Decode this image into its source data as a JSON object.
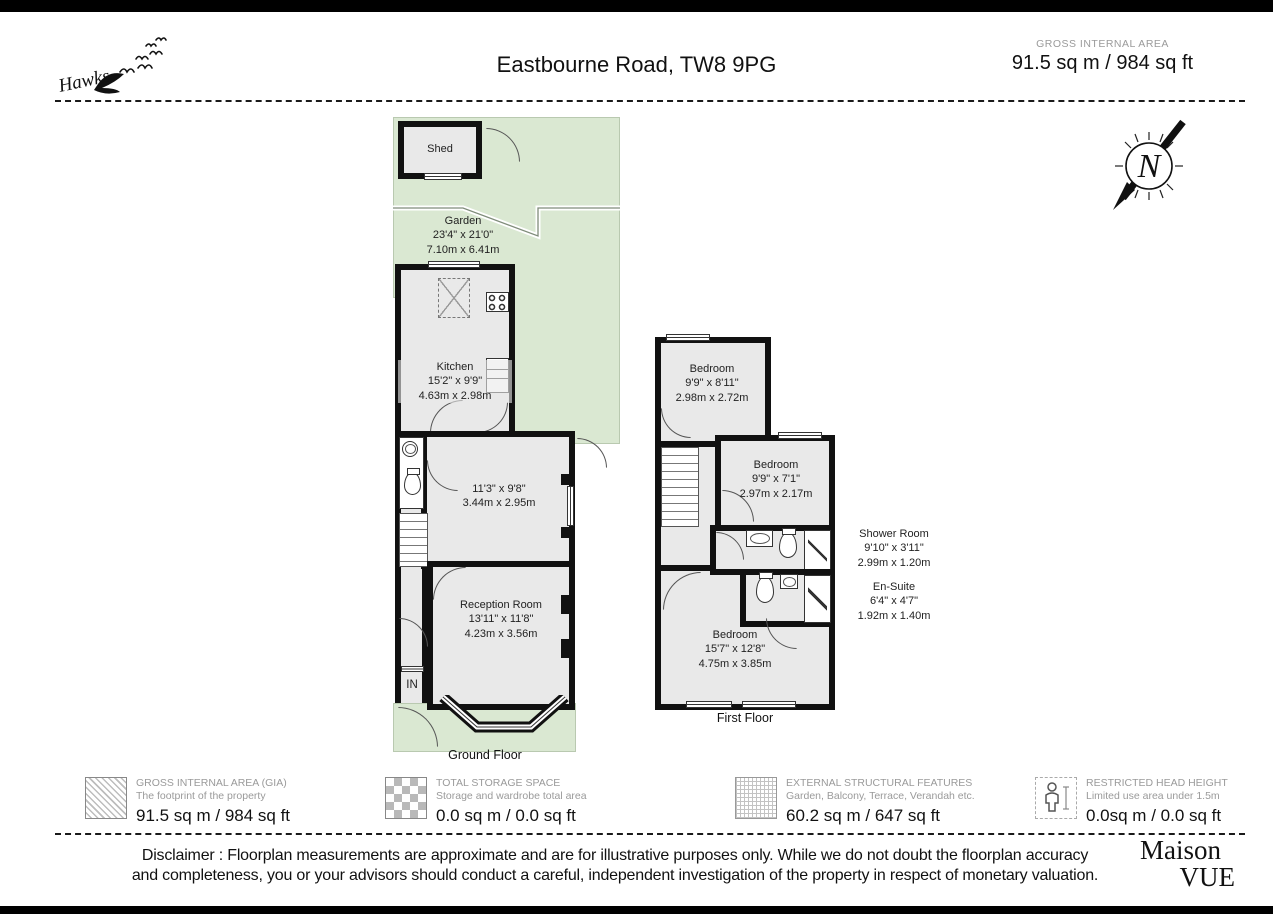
{
  "header": {
    "logo": "Hawks",
    "title": "Eastbourne Road, TW8 9PG",
    "gia_label": "GROSS INTERNAL AREA",
    "gia_value": "91.5 sq m / 984 sq ft"
  },
  "compass": {
    "letter": "N"
  },
  "ground_floor": {
    "caption": "Ground Floor",
    "entrance_label": "IN",
    "shed": {
      "name": "Shed"
    },
    "garden": {
      "name": "Garden",
      "imperial": "23'4\" x 21'0\"",
      "metric": "7.10m x 6.41m"
    },
    "kitchen": {
      "name": "Kitchen",
      "imperial": "15'2\" x 9'9\"",
      "metric": "4.63m x 2.98m"
    },
    "dining": {
      "imperial": "11'3\" x 9'8\"",
      "metric": "3.44m x 2.95m"
    },
    "reception": {
      "name": "Reception Room",
      "imperial": "13'11\" x 11'8\"",
      "metric": "4.23m x 3.56m"
    }
  },
  "first_floor": {
    "caption": "First Floor",
    "bedroom1": {
      "name": "Bedroom",
      "imperial": "9'9\" x 8'11\"",
      "metric": "2.98m x 2.72m"
    },
    "bedroom2": {
      "name": "Bedroom",
      "imperial": "9'9\" x 7'1\"",
      "metric": "2.97m x 2.17m"
    },
    "shower_room": {
      "name": "Shower Room",
      "imperial": "9'10\" x 3'11\"",
      "metric": "2.99m x 1.20m"
    },
    "ensuite": {
      "name": "En-Suite",
      "imperial": "6'4\" x 4'7\"",
      "metric": "1.92m x 1.40m"
    },
    "bedroom3": {
      "name": "Bedroom",
      "imperial": "15'7\" x 12'8\"",
      "metric": "4.75m x 3.85m"
    }
  },
  "legend": [
    {
      "title": "GROSS INTERNAL AREA (GIA)",
      "subtitle": "The footprint of the property",
      "value": "91.5 sq m / 984 sq ft"
    },
    {
      "title": "TOTAL STORAGE SPACE",
      "subtitle": "Storage and wardrobe total area",
      "value": "0.0 sq m / 0.0 sq ft"
    },
    {
      "title": "EXTERNAL STRUCTURAL FEATURES",
      "subtitle": "Garden, Balcony, Terrace, Verandah etc.",
      "value": "60.2 sq m / 647 sq ft"
    },
    {
      "title": "RESTRICTED HEAD HEIGHT",
      "subtitle": "Limited use area under 1.5m",
      "value": "0.0sq m / 0.0 sq ft"
    }
  ],
  "footer": {
    "disclaimer_line1": "Disclaimer : Floorplan measurements are approximate and are for illustrative purposes only. While we do not doubt the floorplan accuracy",
    "disclaimer_line2": "and completeness, you or your advisors should conduct a careful, independent investigation of the property in respect of monetary valuation.",
    "brand_line1": "Maison",
    "brand_line2": "VUE"
  },
  "colors": {
    "garden_green": "#dae8d2",
    "room_fill": "#e9e9e9",
    "wall": "#111111"
  }
}
